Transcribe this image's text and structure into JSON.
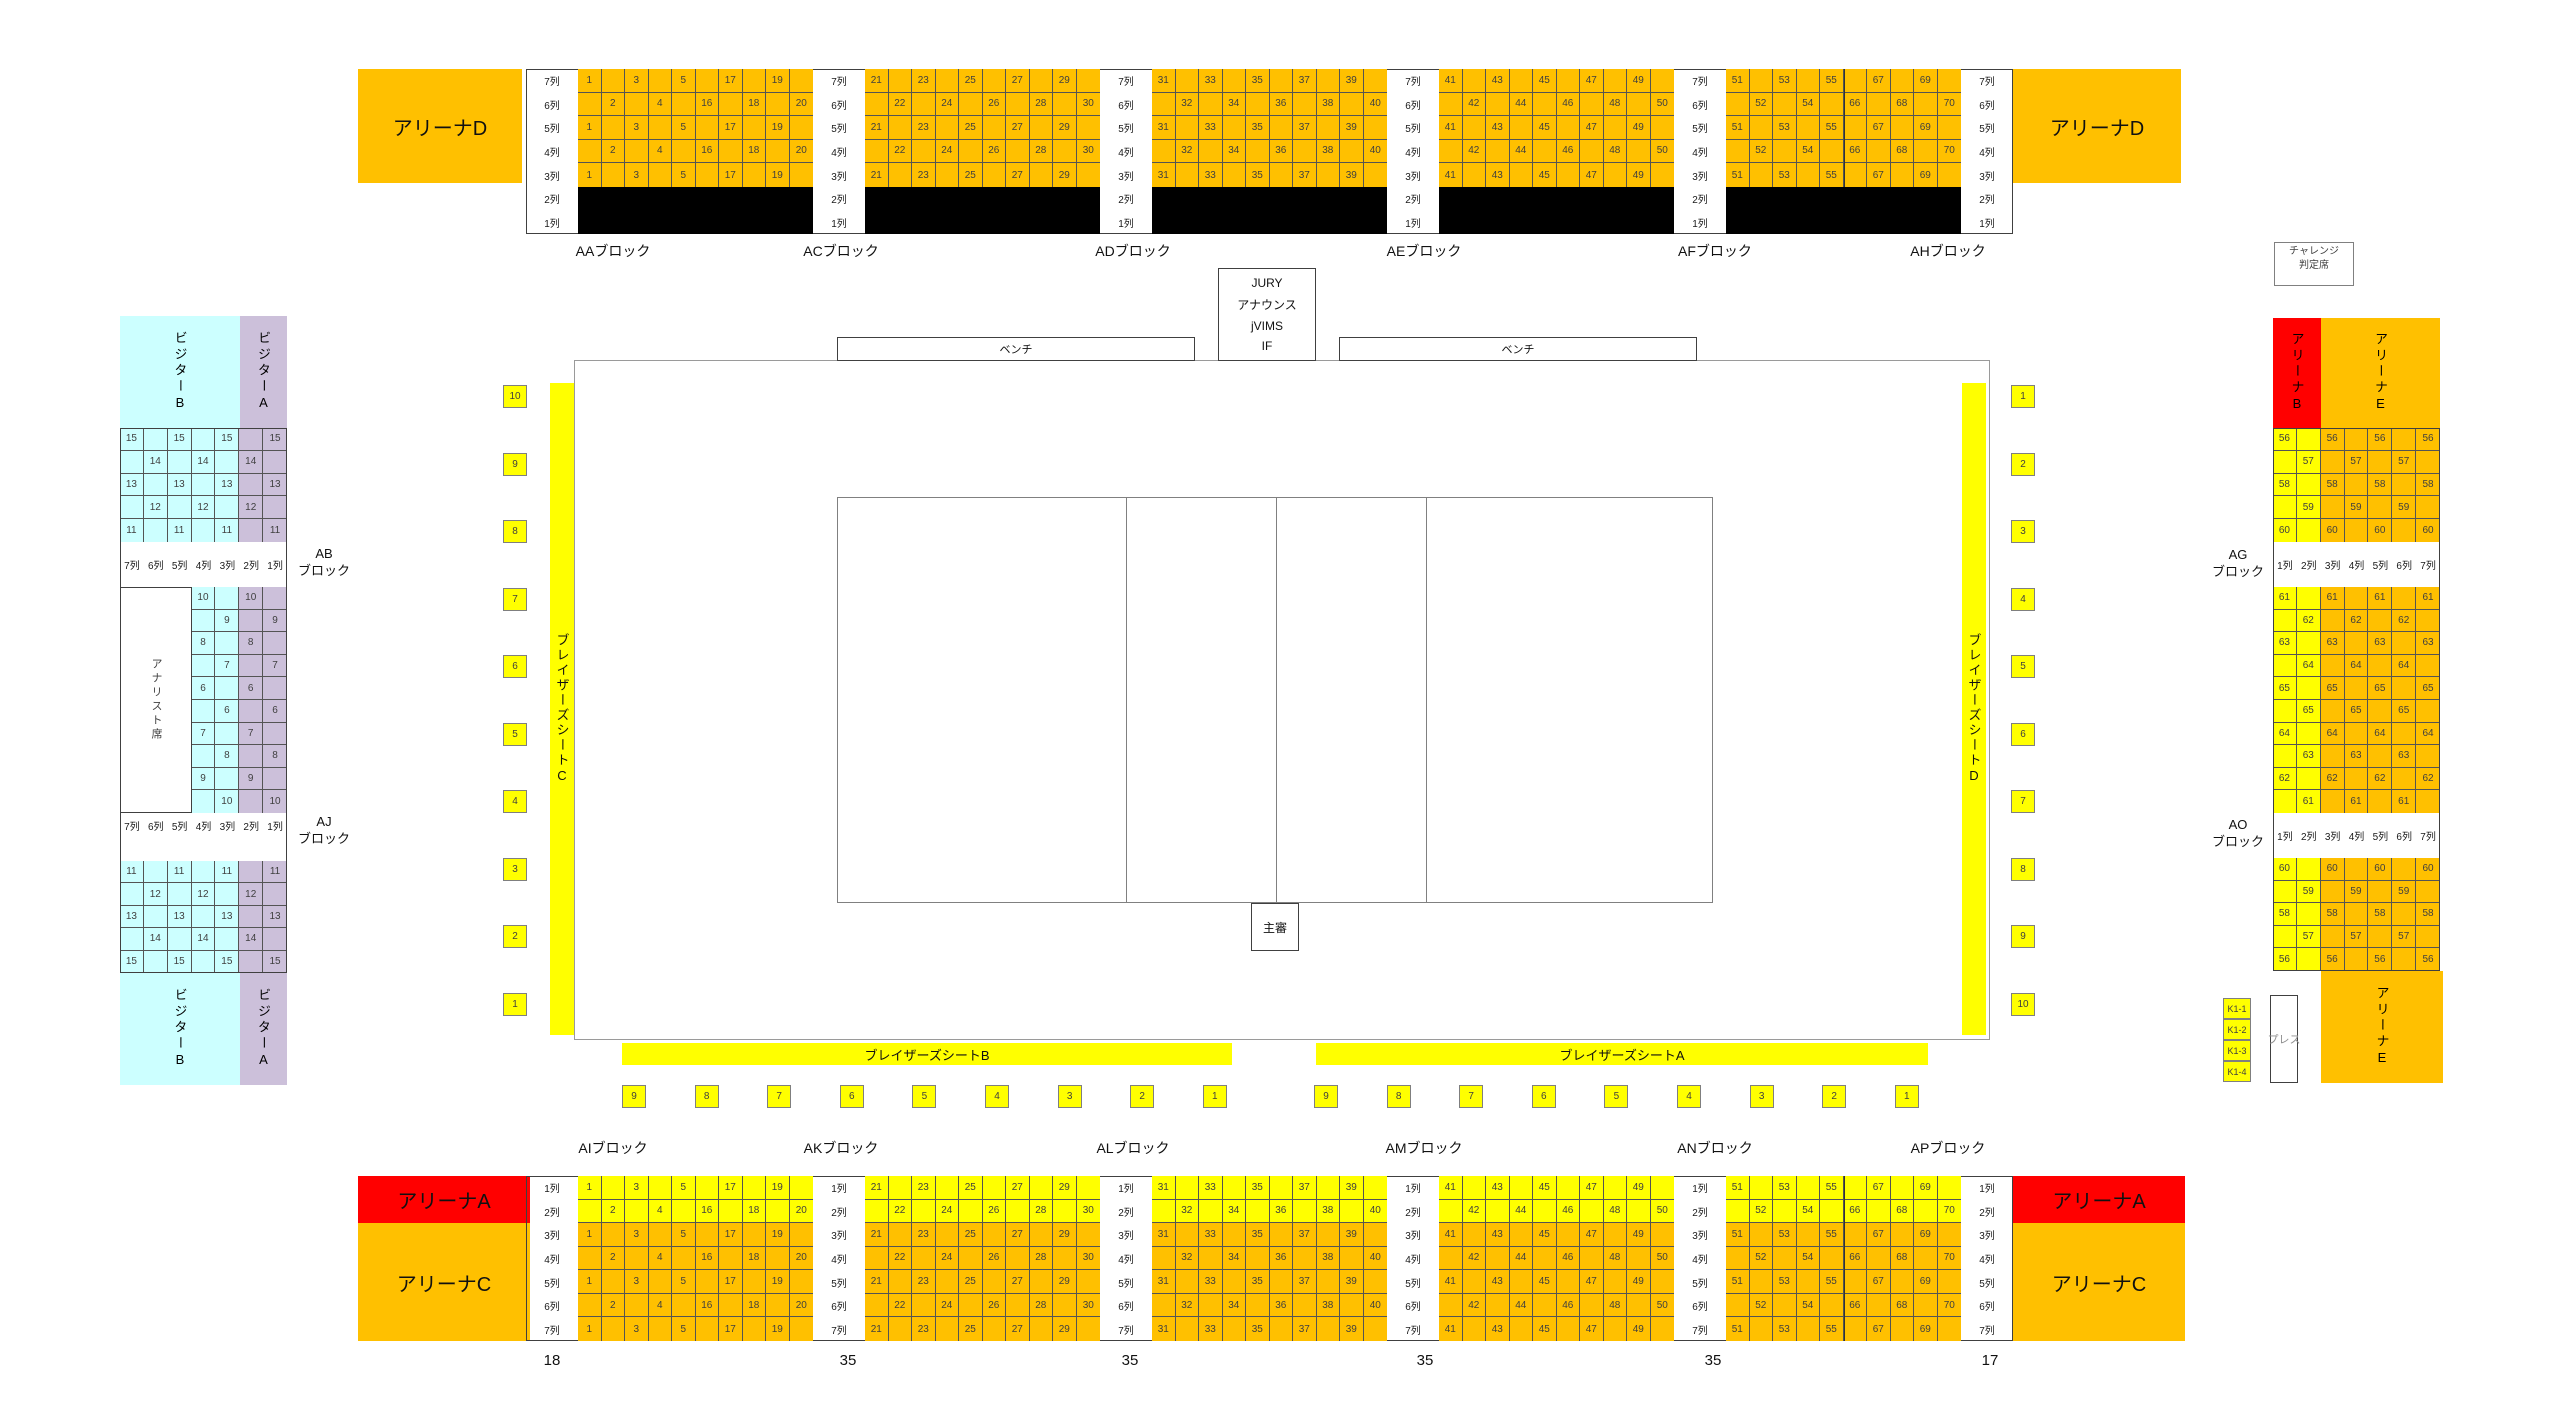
{
  "colors": {
    "orange": "#FFC000",
    "yellow": "#FFFF00",
    "red": "#FF0000",
    "cyan": "#CCFFFF",
    "lavender": "#CCC0DA",
    "black": "#000000",
    "seat_text": "#3F3F3F"
  },
  "top_band": {
    "corner_left": "アリーナD",
    "corner_right": "アリーナD",
    "row_labels": [
      "7列",
      "6列",
      "5列",
      "4列",
      "3列",
      "2列",
      "1列"
    ],
    "block_labels": [
      "AAブロック",
      "ACブロック",
      "ADブロック",
      "AEブロック",
      "AFブロック",
      "AHブロック"
    ],
    "grids": [
      {
        "odd": [
          "1",
          "",
          "3",
          "",
          "5",
          "",
          "17",
          "",
          "19",
          ""
        ],
        "even": [
          "",
          "2",
          "",
          "4",
          "",
          "16",
          "",
          "18",
          "",
          "20"
        ]
      },
      {
        "odd": [
          "21",
          "",
          "23",
          "",
          "25",
          "",
          "27",
          "",
          "29",
          ""
        ],
        "even": [
          "",
          "22",
          "",
          "24",
          "",
          "26",
          "",
          "28",
          "",
          "30"
        ]
      },
      {
        "odd": [
          "31",
          "",
          "33",
          "",
          "35",
          "",
          "37",
          "",
          "39",
          ""
        ],
        "even": [
          "",
          "32",
          "",
          "34",
          "",
          "36",
          "",
          "38",
          "",
          "40"
        ]
      },
      {
        "odd": [
          "41",
          "",
          "43",
          "",
          "45",
          "",
          "47",
          "",
          "49",
          ""
        ],
        "even": [
          "",
          "42",
          "",
          "44",
          "",
          "46",
          "",
          "48",
          "",
          "50"
        ]
      },
      {
        "odd": [
          "51",
          "",
          "53",
          "",
          "55",
          "",
          "67",
          "",
          "69",
          ""
        ],
        "even": [
          "",
          "52",
          "",
          "54",
          "",
          "66",
          "",
          "68",
          "",
          "70"
        ]
      }
    ]
  },
  "bottom_band": {
    "corner_left_top": "アリーナA",
    "corner_left_bottom": "アリーナC",
    "corner_right_top": "アリーナA",
    "corner_right_bottom": "アリーナC",
    "row_labels": [
      "1列",
      "2列",
      "3列",
      "4列",
      "5列",
      "6列",
      "7列"
    ],
    "block_labels": [
      "AIブロック",
      "AKブロック",
      "ALブロック",
      "AMブロック",
      "ANブロック",
      "APブロック"
    ],
    "gate_numbers": [
      "18",
      "35",
      "35",
      "35",
      "35",
      "17"
    ],
    "grids": [
      {
        "odd": [
          "1",
          "",
          "3",
          "",
          "5",
          "",
          "17",
          "",
          "19",
          ""
        ],
        "even": [
          "",
          "2",
          "",
          "4",
          "",
          "16",
          "",
          "18",
          "",
          "20"
        ]
      },
      {
        "odd": [
          "21",
          "",
          "23",
          "",
          "25",
          "",
          "27",
          "",
          "29",
          ""
        ],
        "even": [
          "",
          "22",
          "",
          "24",
          "",
          "26",
          "",
          "28",
          "",
          "30"
        ]
      },
      {
        "odd": [
          "31",
          "",
          "33",
          "",
          "35",
          "",
          "37",
          "",
          "39",
          ""
        ],
        "even": [
          "",
          "32",
          "",
          "34",
          "",
          "36",
          "",
          "38",
          "",
          "40"
        ]
      },
      {
        "odd": [
          "41",
          "",
          "43",
          "",
          "45",
          "",
          "47",
          "",
          "49",
          ""
        ],
        "even": [
          "",
          "42",
          "",
          "44",
          "",
          "46",
          "",
          "48",
          "",
          "50"
        ]
      },
      {
        "odd": [
          "51",
          "",
          "53",
          "",
          "55",
          "",
          "67",
          "",
          "69",
          ""
        ],
        "even": [
          "",
          "52",
          "",
          "54",
          "",
          "66",
          "",
          "68",
          "",
          "70"
        ]
      }
    ]
  },
  "left_stand": {
    "visitor_b": "ビジターB",
    "visitor_a": "ビジターA",
    "visitor_b_bottom": "ビジターB",
    "visitor_a_bottom": "ビジターA",
    "analyst": "アナリスト席",
    "ab_block": {
      "line1": "AB",
      "line2": "ブロック"
    },
    "aj_block": {
      "line1": "AJ",
      "line2": "ブロック"
    },
    "row_labels": [
      "7列",
      "6列",
      "5列",
      "4列",
      "3列",
      "2列",
      "1列"
    ],
    "upper_rows": [
      [
        "15",
        "",
        "15",
        "",
        "15",
        "",
        "15"
      ],
      [
        "",
        "14",
        "",
        "14",
        "",
        "14",
        ""
      ],
      [
        "13",
        "",
        "13",
        "",
        "13",
        "",
        "13"
      ],
      [
        "",
        "12",
        "",
        "12",
        "",
        "12",
        ""
      ],
      [
        "11",
        "",
        "11",
        "",
        "11",
        "",
        "11"
      ]
    ],
    "middle_rows": [
      [
        "10",
        "",
        "10",
        ""
      ],
      [
        "",
        "9",
        "",
        "9"
      ],
      [
        "8",
        "",
        "8",
        ""
      ],
      [
        "",
        "7",
        "",
        "7"
      ],
      [
        "6",
        "",
        "6",
        ""
      ],
      [
        "",
        "6",
        "",
        "6"
      ],
      [
        "7",
        "",
        "7",
        ""
      ],
      [
        "",
        "8",
        "",
        "8"
      ],
      [
        "9",
        "",
        "9",
        ""
      ],
      [
        "",
        "10",
        "",
        "10"
      ]
    ],
    "lower_rows": [
      [
        "11",
        "",
        "11",
        "",
        "11",
        "",
        "11"
      ],
      [
        "",
        "12",
        "",
        "12",
        "",
        "12",
        ""
      ],
      [
        "13",
        "",
        "13",
        "",
        "13",
        "",
        "13"
      ],
      [
        "",
        "14",
        "",
        "14",
        "",
        "14",
        ""
      ],
      [
        "15",
        "",
        "15",
        "",
        "15",
        "",
        "15"
      ]
    ]
  },
  "right_stand": {
    "challenge": {
      "line1": "チャレンジ",
      "line2": "判定席"
    },
    "arena_b": "アリーナB",
    "arena_e": "アリーナE",
    "arena_e_footer": "アリーナE",
    "press": "プレス",
    "ag_block": {
      "line1": "AG",
      "line2": "ブロック"
    },
    "ao_block": {
      "line1": "AO",
      "line2": "ブロック"
    },
    "k1_boxes": [
      "K1-1",
      "K1-2",
      "K1-3",
      "K1-4"
    ],
    "row_labels": [
      "1列",
      "2列",
      "3列",
      "4列",
      "5列",
      "6列",
      "7列"
    ],
    "upper_rows": [
      [
        "56",
        "",
        "56",
        "",
        "56",
        "",
        "56"
      ],
      [
        "",
        "57",
        "",
        "57",
        "",
        "57",
        ""
      ],
      [
        "58",
        "",
        "58",
        "",
        "58",
        "",
        "58"
      ],
      [
        "",
        "59",
        "",
        "59",
        "",
        "59",
        ""
      ],
      [
        "60",
        "",
        "60",
        "",
        "60",
        "",
        "60"
      ]
    ],
    "middle_rows": [
      [
        "61",
        "",
        "61",
        "",
        "61",
        "",
        "61"
      ],
      [
        "",
        "62",
        "",
        "62",
        "",
        "62",
        ""
      ],
      [
        "63",
        "",
        "63",
        "",
        "63",
        "",
        "63"
      ],
      [
        "",
        "64",
        "",
        "64",
        "",
        "64",
        ""
      ],
      [
        "65",
        "",
        "65",
        "",
        "65",
        "",
        "65"
      ],
      [
        "",
        "65",
        "",
        "65",
        "",
        "65",
        ""
      ],
      [
        "64",
        "",
        "64",
        "",
        "64",
        "",
        "64"
      ],
      [
        "",
        "63",
        "",
        "63",
        "",
        "63",
        ""
      ],
      [
        "62",
        "",
        "62",
        "",
        "62",
        "",
        "62"
      ],
      [
        "",
        "61",
        "",
        "61",
        "",
        "61",
        ""
      ]
    ],
    "lower_rows": [
      [
        "60",
        "",
        "60",
        "",
        "60",
        "",
        "60"
      ],
      [
        "",
        "59",
        "",
        "59",
        "",
        "59",
        ""
      ],
      [
        "58",
        "",
        "58",
        "",
        "58",
        "",
        "58"
      ],
      [
        "",
        "57",
        "",
        "57",
        "",
        "57",
        ""
      ],
      [
        "56",
        "",
        "56",
        "",
        "56",
        "",
        "56"
      ]
    ]
  },
  "court": {
    "jury_lines": [
      "JURY",
      "アナウンス",
      "jVIMS",
      "IF"
    ],
    "bench_left": "ベンチ",
    "bench_right": "ベンチ",
    "referee": "主審",
    "players_seat_a": "ブレイザーズシートA",
    "players_seat_b": "ブレイザーズシートB",
    "players_seat_c": "ブレイザーズシートC",
    "players_seat_d": "ブレイザーズシートD",
    "left_squares": [
      "10",
      "9",
      "8",
      "7",
      "6",
      "5",
      "4",
      "3",
      "2",
      "1"
    ],
    "right_squares": [
      "1",
      "2",
      "3",
      "4",
      "5",
      "6",
      "7",
      "8",
      "9",
      "10"
    ],
    "bottom_left_squares": [
      "9",
      "8",
      "7",
      "6",
      "5",
      "4",
      "3",
      "2",
      "1"
    ],
    "bottom_right_squares": [
      "9",
      "8",
      "7",
      "6",
      "5",
      "4",
      "3",
      "2",
      "1"
    ]
  }
}
